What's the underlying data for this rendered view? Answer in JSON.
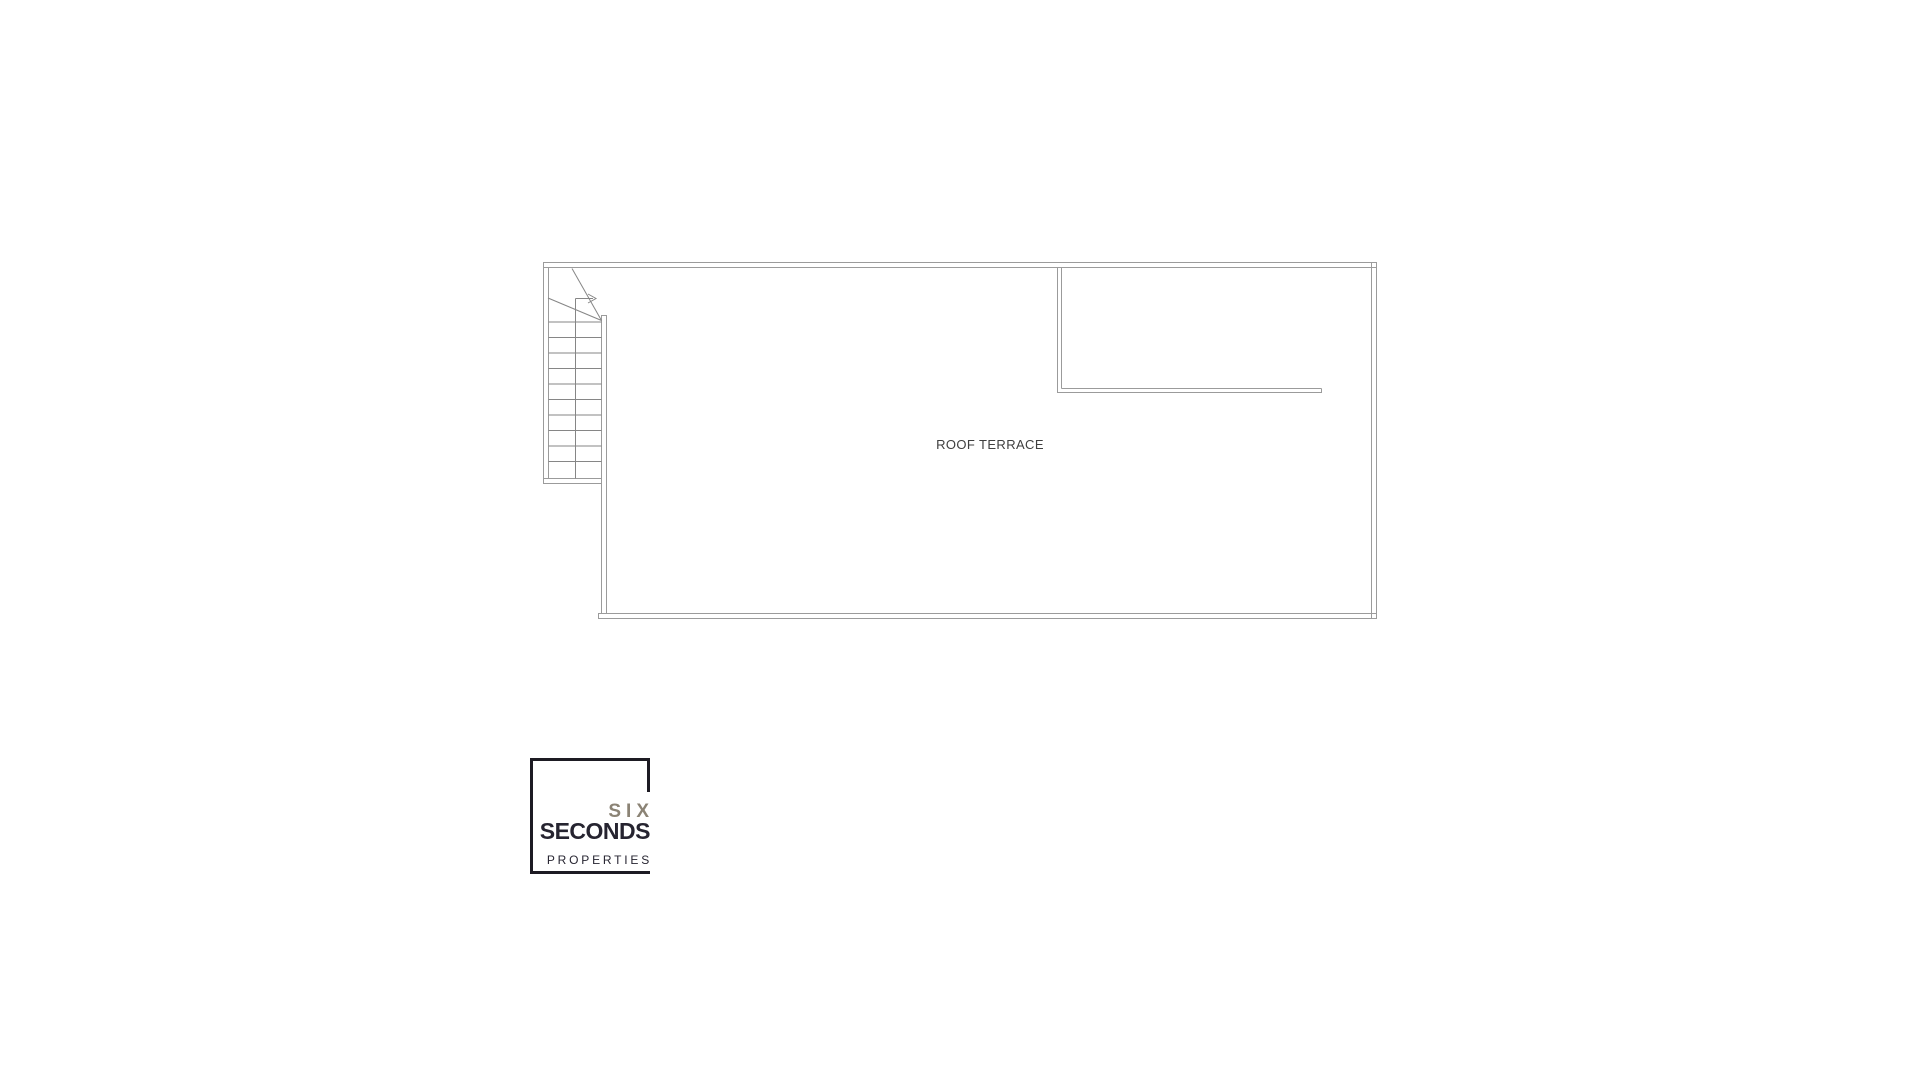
{
  "page": {
    "background": "#ffffff"
  },
  "plan": {
    "room_label": "ROOF TERRACE"
  },
  "logo": {
    "brand_top": "SIX",
    "brand_main": "SECONDS",
    "brand_sub": "PROPERTIES"
  },
  "colors": {
    "wall_line": "#9b9b9b",
    "stair_line": "#868686",
    "room_label_text": "#3f3f3f",
    "logo_frame": "#1d1b23",
    "logo_accent": "#8b8375",
    "logo_dark": "#262430"
  }
}
